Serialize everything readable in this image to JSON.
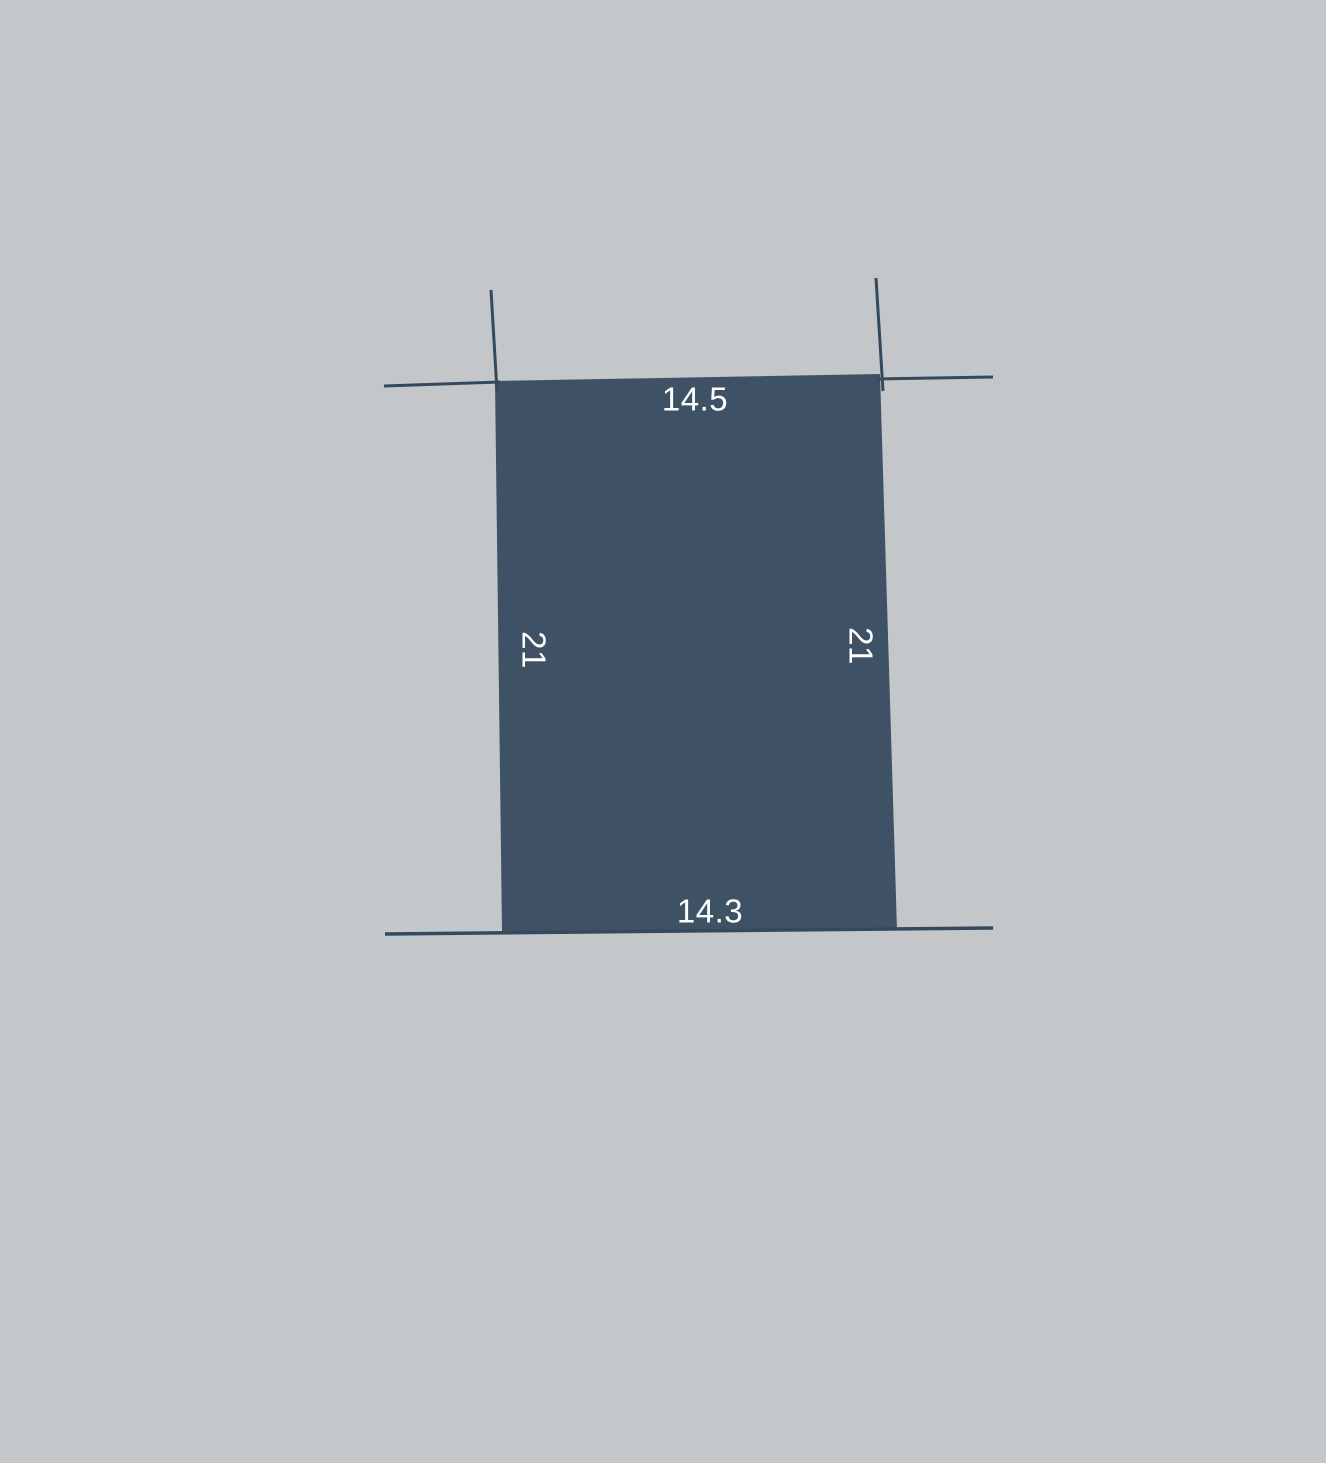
{
  "figure": {
    "type": "parcel-lot-diagram",
    "colors": {
      "background": "#c3c7ca",
      "parcel_fill": "#3f5265",
      "boundary_line": "#35495c",
      "label_text": "#ffffff"
    },
    "parcel_polygon_points": "495,381 880,374 897,930 502,932",
    "extension_lines": [
      {
        "name": "top-left-vertical-tick",
        "x1": 491,
        "y1": 290,
        "x2": 497,
        "y2": 391,
        "width": 3
      },
      {
        "name": "top-left-horizontal-tick",
        "x1": 384,
        "y1": 386,
        "x2": 500,
        "y2": 382,
        "width": 3
      },
      {
        "name": "top-right-vertical-tick",
        "x1": 876,
        "y1": 278,
        "x2": 883,
        "y2": 391,
        "width": 3
      },
      {
        "name": "top-right-horizontal-tick",
        "x1": 877,
        "y1": 379,
        "x2": 993,
        "y2": 377,
        "width": 3
      },
      {
        "name": "bottom-boundary-line",
        "x1": 385,
        "y1": 934,
        "x2": 993,
        "y2": 928,
        "width": 3.5
      }
    ],
    "labels": [
      {
        "name": "top-side-length",
        "text": "14.5",
        "x": 695,
        "y": 399,
        "rotation": 0
      },
      {
        "name": "bottom-side-length",
        "text": "14.3",
        "x": 710,
        "y": 911,
        "rotation": 0
      },
      {
        "name": "left-side-length",
        "text": "21",
        "x": 534,
        "y": 650,
        "rotation": 90
      },
      {
        "name": "right-side-length",
        "text": "21",
        "x": 861,
        "y": 646,
        "rotation": 90
      }
    ]
  }
}
